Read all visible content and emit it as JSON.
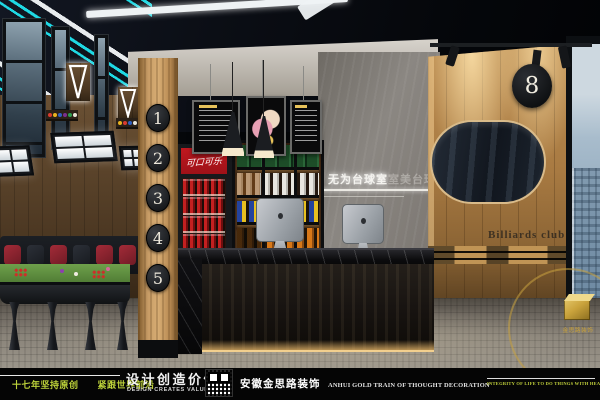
{
  "scene": {
    "pillar_numbers": [
      "1",
      "2",
      "3",
      "4",
      "5"
    ],
    "room_number": "8",
    "wall_sign_bright": "无为台球室",
    "wall_sign_faint": "室美台球",
    "right_wall_text": "Billiards club",
    "cooler_brand": "可口可乐",
    "watermark_text": "金思路装饰",
    "colors": {
      "neon_cyan": "#1fd9e4",
      "wood": "#c79c66",
      "cooler_red": "#c0181f",
      "table_green": "#5c8f3d",
      "watermark_gold": "#c9a23b"
    }
  },
  "footer": {
    "slogan_left": "十七年坚持原创　　紧跟世界前沿",
    "tagline_cn": "设计创造价值",
    "tagline_en": "DESIGN CREATES VALUE",
    "company_cn": "安徽金思路装饰",
    "company_en": "ANHUI GOLD TRAIN OF THOUGHT DECORATION",
    "slogan_right": "INTEGRITY OF LIFE TO DO THINGS WITH HEART",
    "accent_green": "#bdd23a"
  }
}
